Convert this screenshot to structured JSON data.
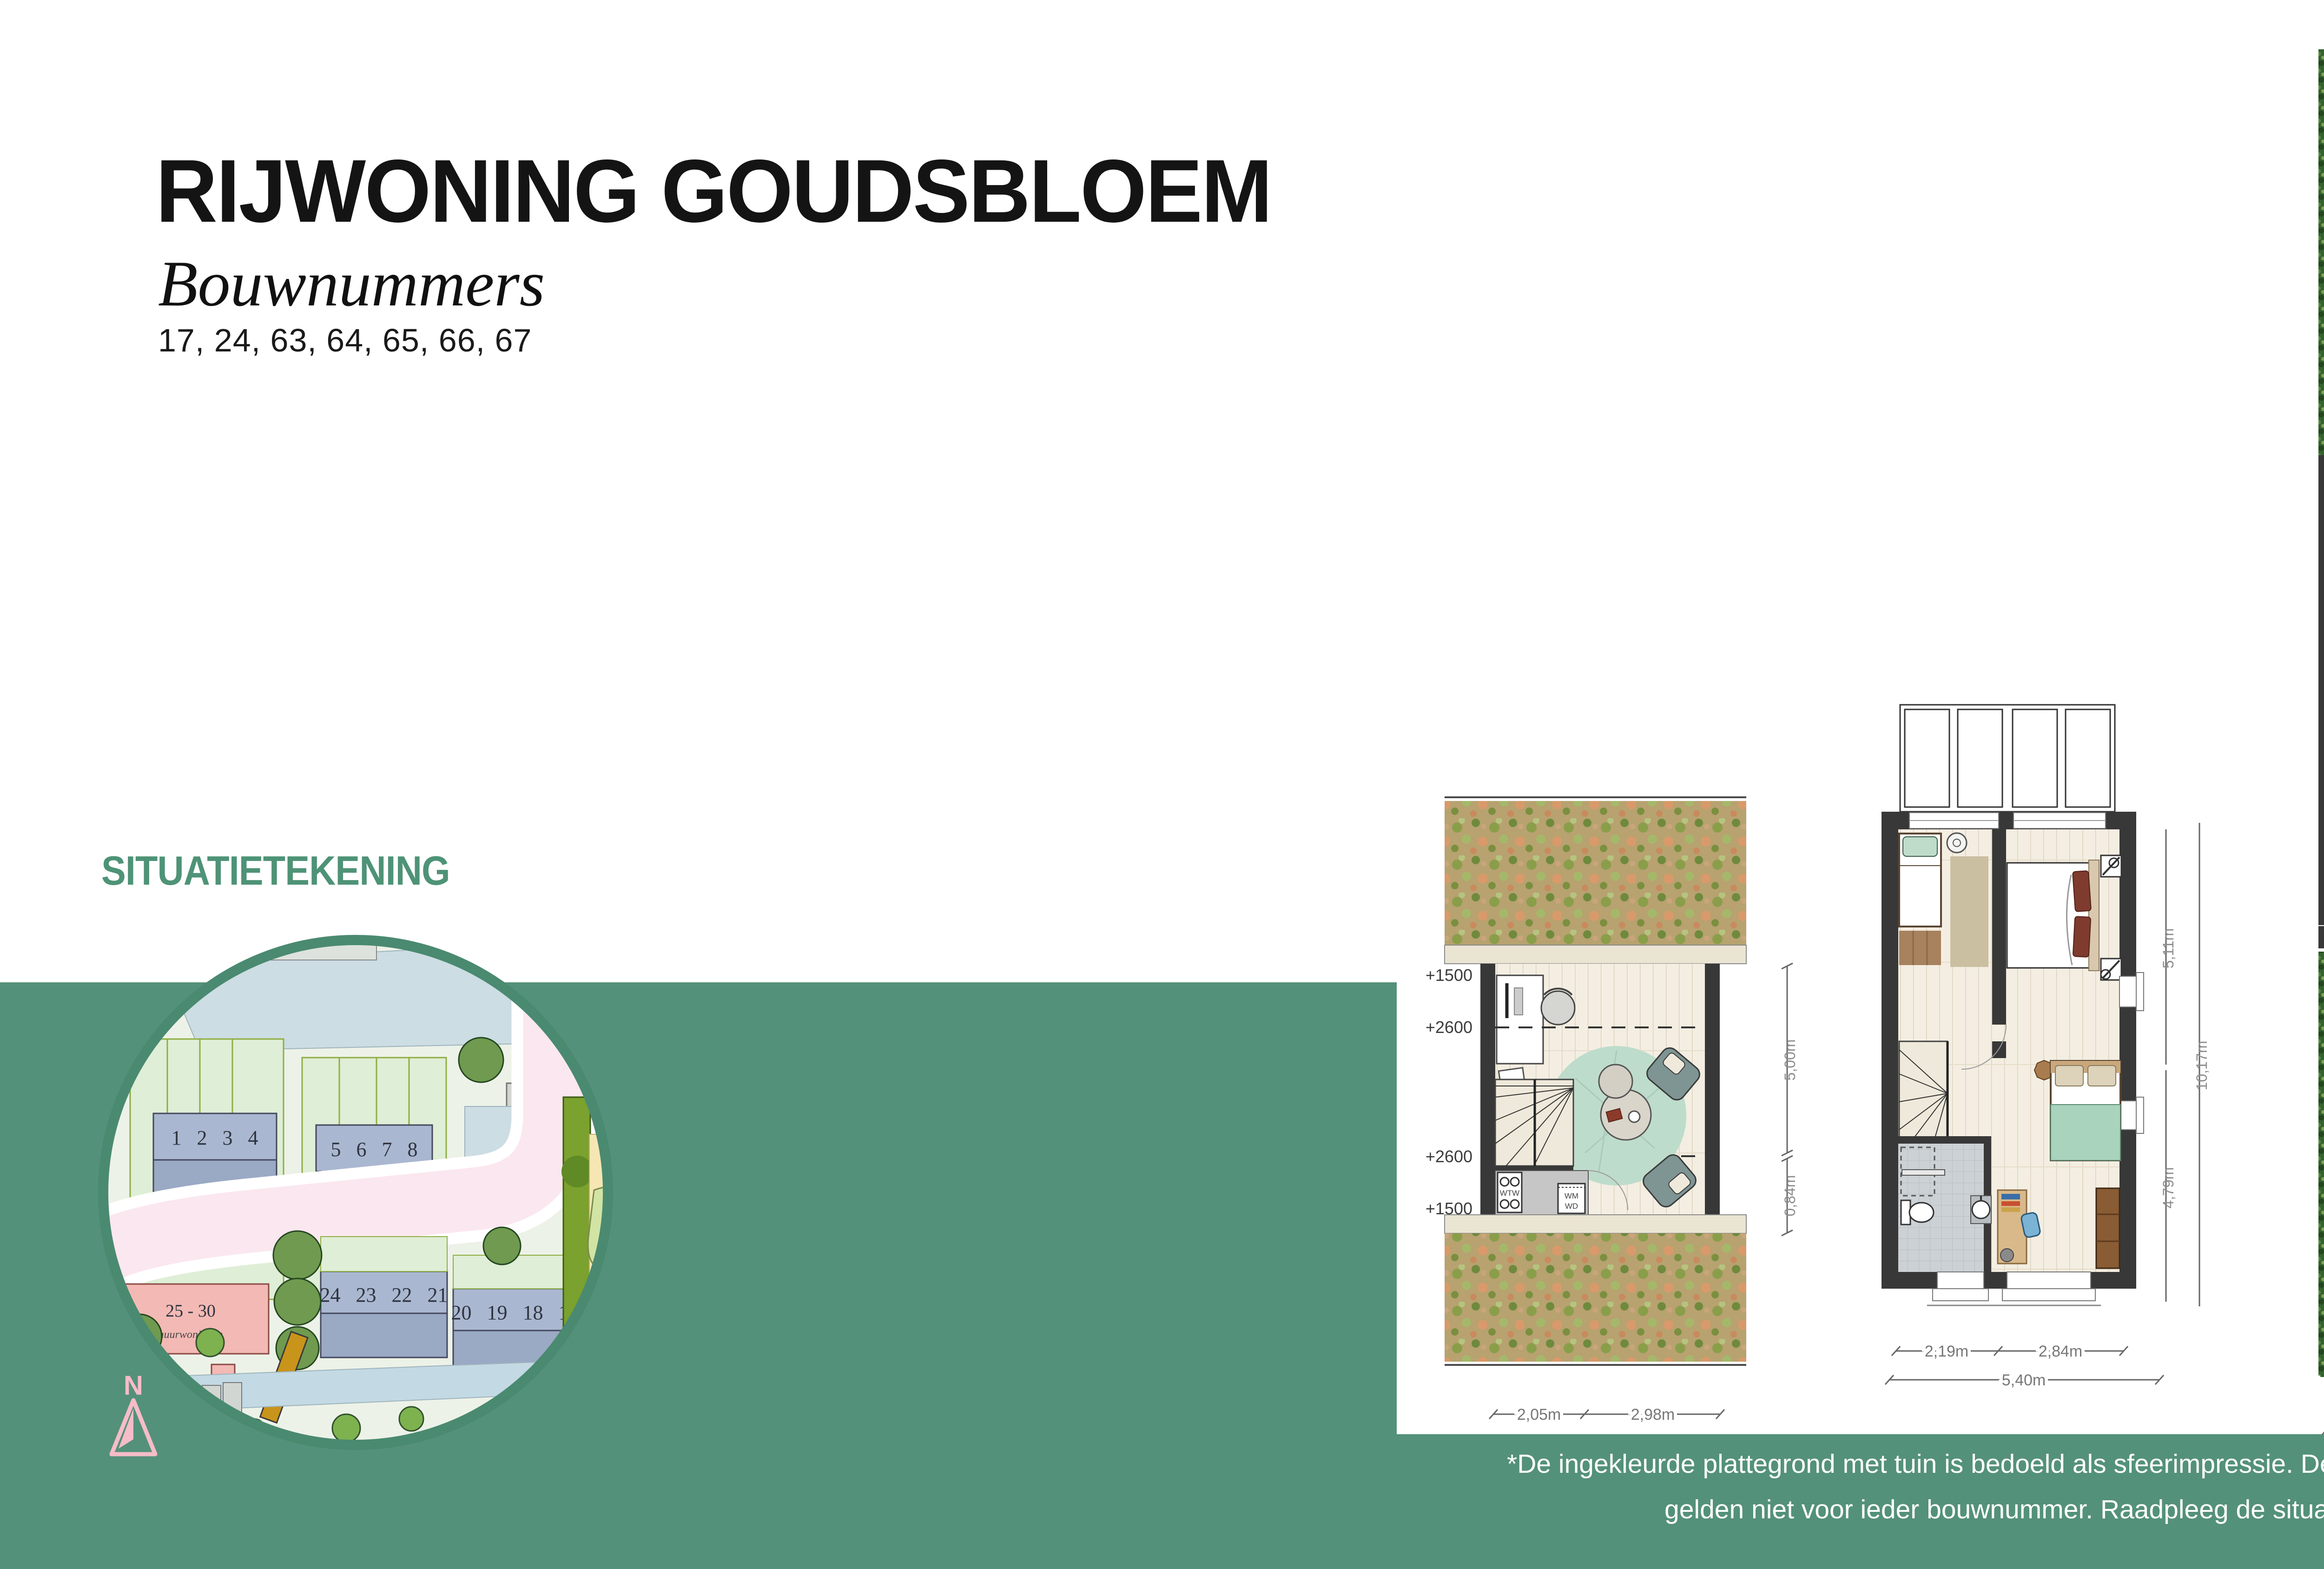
{
  "header": {
    "title": "RIJWONING GOUDSBLOEM",
    "subtitle": "Bouwnummers",
    "numbers": "17, 24, 63, 64, 65, 66, 67"
  },
  "section_label": "SITUATIETEKENING",
  "footnote": {
    "line1": "*De ingekleurde plattegrond met tuin is bedoeld als sfeerimpressie. De getoonde tuinindeling en -grootte",
    "line2": "gelden niet voor ieder bouwnummer. Raadpleeg de situatietekening voor de exacte situatie"
  },
  "site_map": {
    "compass_label": "N",
    "building_rows": [
      {
        "label": "1 2 3 4"
      },
      {
        "label": "5 6 7 8"
      },
      {
        "label": "24 23 22 21"
      },
      {
        "label": "20 19 18 17"
      }
    ],
    "rental_left": {
      "label": "- 36",
      "sub": "huurwoningen"
    },
    "rental_mid": {
      "label": "25 - 30",
      "sub": "huurwoningen"
    },
    "playground": {
      "line1": "Speel",
      "line2": "plek"
    }
  },
  "attic_plan": {
    "elevations": [
      "+1500",
      "+2600",
      "+2600",
      "+1500"
    ],
    "labels": {
      "wtw": "WTW",
      "wm": "WM",
      "wd": "WD"
    },
    "dims": {
      "right_room": "5,00m",
      "right_low": "0,84m",
      "bottom_left": "2,05m",
      "bottom_right": "2,98m"
    }
  },
  "floor_plan": {
    "dims": {
      "right_top": "5,11m",
      "right_bottom": "4,79m",
      "right_total": "10,17m",
      "bottom_left": "2,19m",
      "bottom_right": "2,84m",
      "bottom_total": "5,40m"
    }
  },
  "ground_plan": {
    "labels": {
      "wp": "WP",
      "berging": "BERGING"
    },
    "dims": {
      "garden_back": "9,20m",
      "house_top": "7,05m",
      "house_bottom": "2,85m",
      "garden_front": "9,00m",
      "house_total": "10,76m",
      "bottom_left": "2,26m",
      "bottom_right": "2,70m",
      "bottom_total": "5,40m"
    }
  },
  "colors": {
    "band_green": "#54917a",
    "ring_green": "#4a8a70",
    "accent_green": "#4e9377",
    "footnote_white": "#ffffff"
  }
}
